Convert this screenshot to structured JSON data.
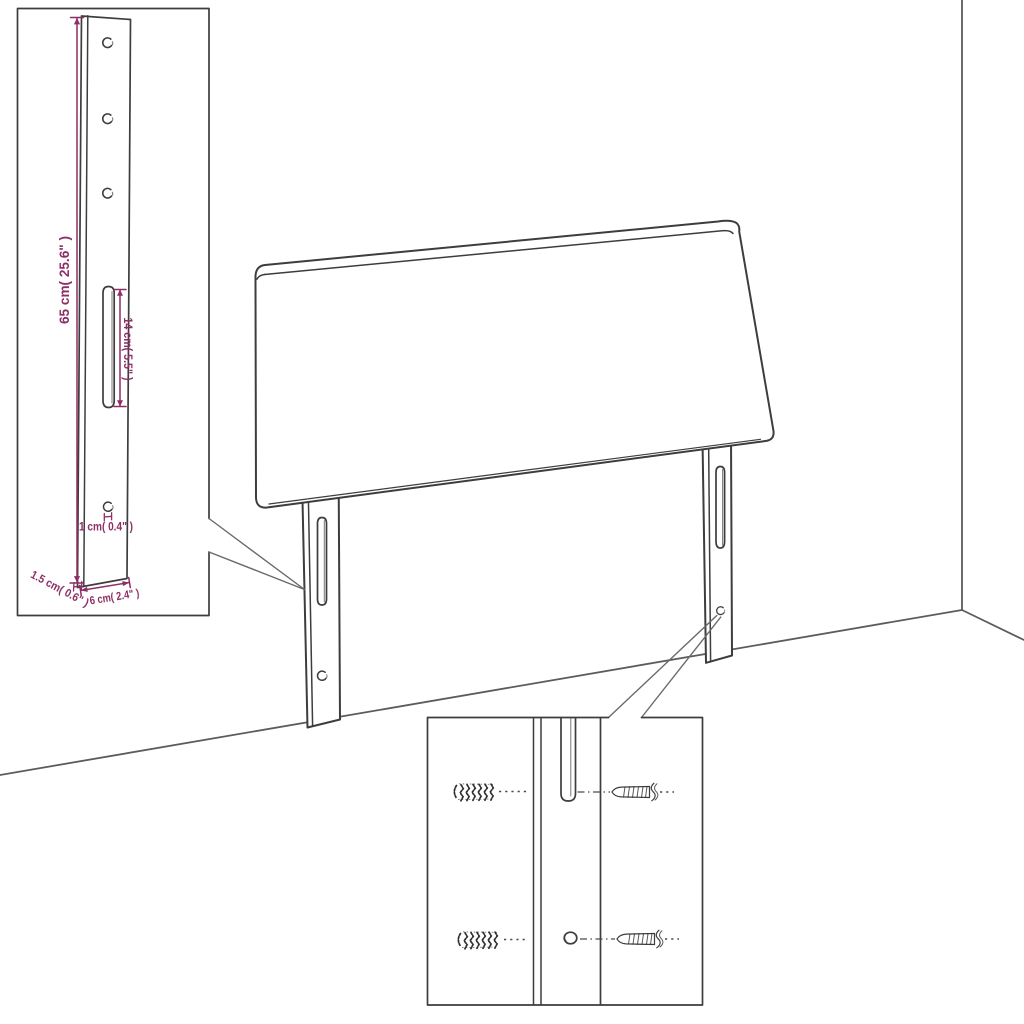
{
  "diagram": {
    "subject": "headboard wall-mount assembly diagram",
    "background": "#ffffff",
    "line_color": "#3d3d3d",
    "wall_line_color": "#5c5c5c",
    "dimension_color": "#8d2e66"
  },
  "leg_detail_inset": {
    "dimensions": {
      "leg_height": "65 cm( 25.6\" )",
      "slot_length": "14 cm( 5.5\" )",
      "hole_diameter": "1 cm( 0.4\" )",
      "leg_thickness": "1.5 cm( 0.6\" )",
      "leg_width": "6 cm( 2.4\" )"
    }
  }
}
